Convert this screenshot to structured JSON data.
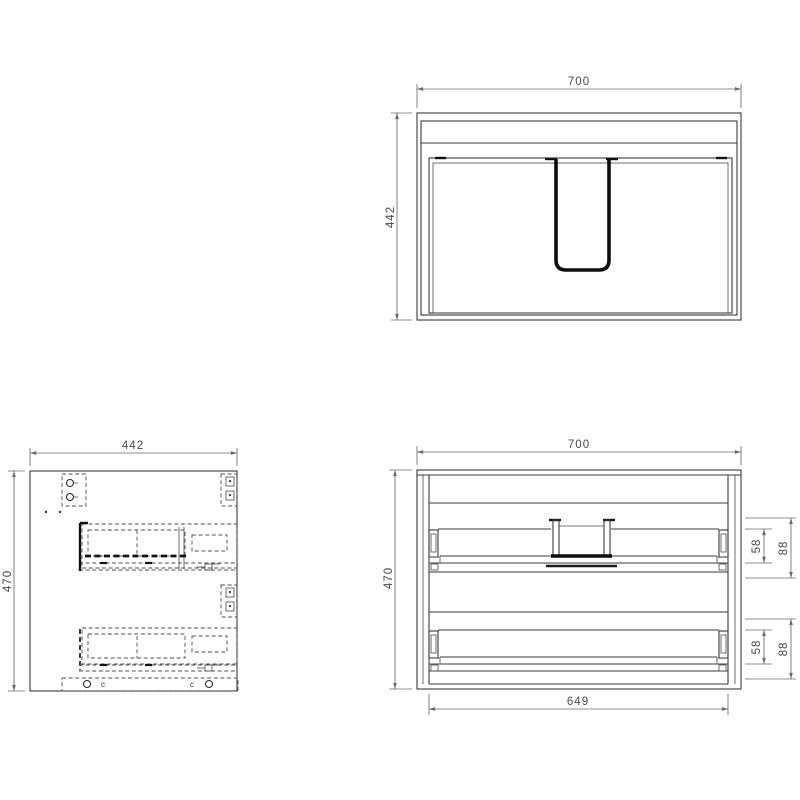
{
  "drawing": {
    "plan_view": {
      "width": "700",
      "depth": "442"
    },
    "side_view": {
      "width": "442",
      "height": "470",
      "cam_fitting_label": "c"
    },
    "front_view": {
      "width": "700",
      "height": "470",
      "inner_width": "649",
      "drawer_box_height": "58",
      "drawer_rail_height": "88"
    }
  },
  "colors": {
    "background": "#ffffff",
    "outline": "#3a3a3a",
    "hidden_line": "#4f4f4f",
    "thick_line": "#0d0d0d",
    "dimension_line": "#6a6a6a",
    "dimension_text": "#4a4a4a"
  }
}
